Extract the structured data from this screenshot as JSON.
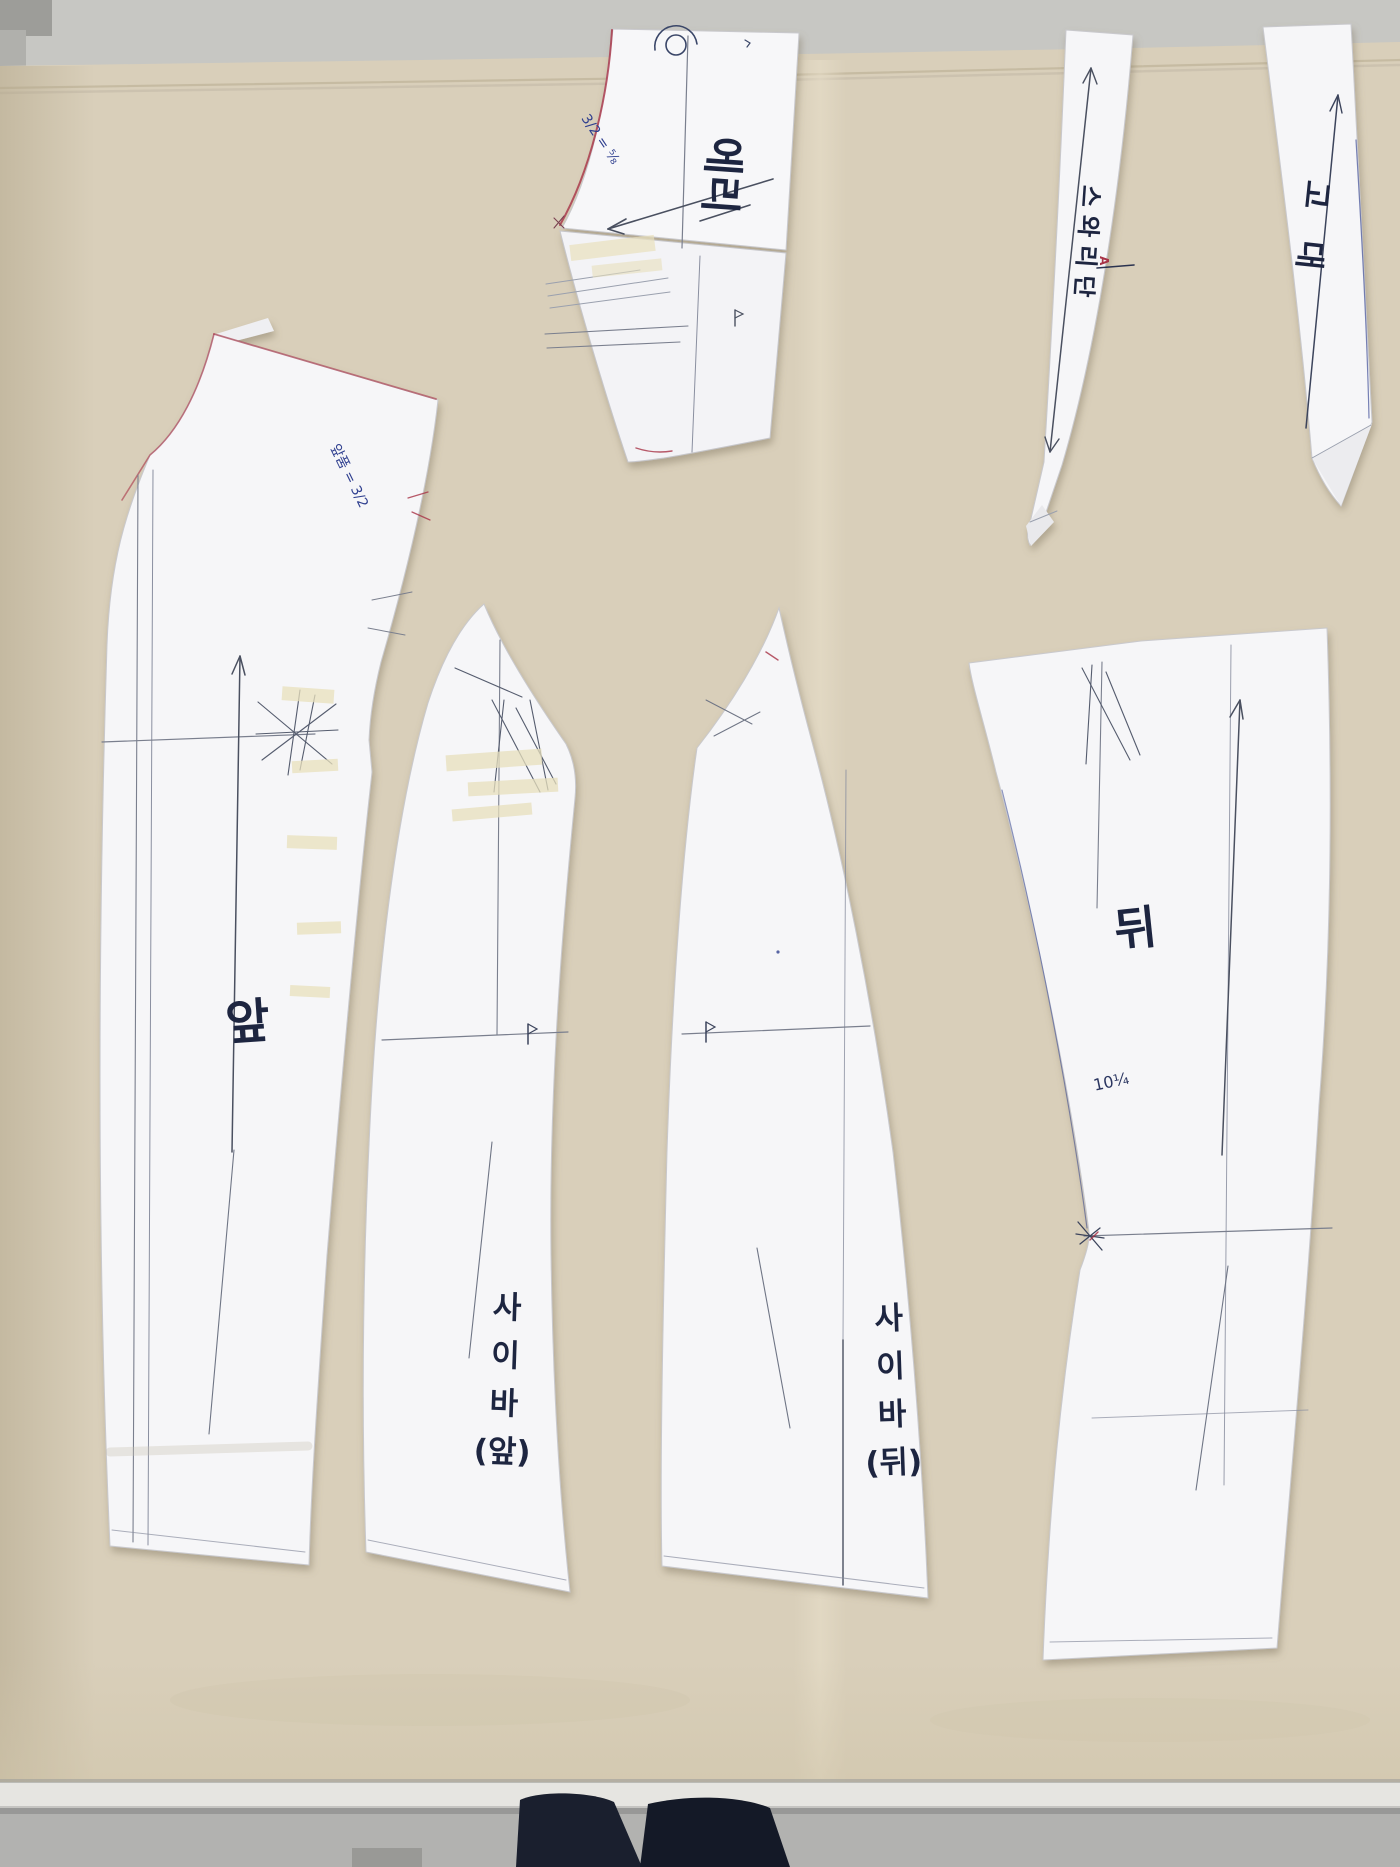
{
  "photo": {
    "labels": {
      "front": "앞",
      "back": "뒤",
      "collar": "에리",
      "strip_a": "스와리단",
      "strip_b": "고대",
      "side_front_lines": [
        "사",
        "이",
        "바",
        "(앞)"
      ],
      "side_back_lines": [
        "사",
        "이",
        "바",
        "(뒤)"
      ]
    },
    "annotations": {
      "collar_note": "3/2 = ⅝",
      "front_note": "앞품 = 3/2",
      "back_measurement": "10¼",
      "strip_a_mark": "A"
    },
    "colors": {
      "fabric": "#d9cfba",
      "paper": "#f5f5f7",
      "pencil": "#6f7585",
      "blue_pen": "#31418f",
      "red_pen": "#a83246",
      "ink": "#1d2540"
    }
  }
}
